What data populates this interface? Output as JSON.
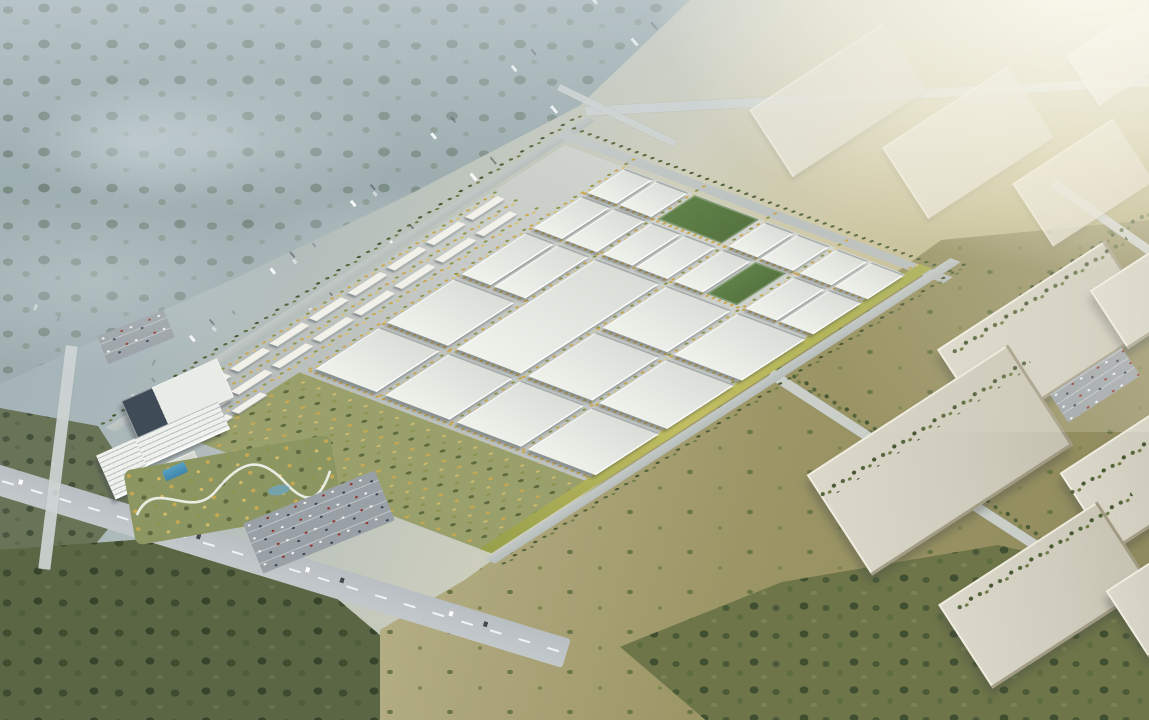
{
  "scene": {
    "type": "aerial-architectural-rendering",
    "subject": "industrial-logistics-park-masterplan",
    "palette": {
      "roof": "#F0F2EC",
      "roofShade": "#D9DCD6",
      "street": "#C6CBC7",
      "ctxRoof": "#CFCCBD",
      "lawn1": "#98A04B",
      "lawn2": "#C1BD62",
      "treeY1": "#CAA64D",
      "treeY2": "#DCC068",
      "treeO": "#8E9449",
      "treeD1": "#55643A",
      "treeD2": "#6F7C46",
      "forestCool": "#5D7063",
      "grassWarm": "#9B9464",
      "sunGlow": "#FFFDF2",
      "mistTint": "rgba(206,215,219,0.5)"
    },
    "park_items": [
      {
        "k": "proad",
        "x": -24,
        "y": -16,
        "w": 565,
        "h": 11,
        "n": "nw-boundary-road"
      },
      {
        "k": "tband",
        "x": -24,
        "y": -27,
        "w": 565,
        "h": 9
      },
      {
        "k": "proad",
        "x": 506,
        "y": -16,
        "w": 11,
        "h": 445,
        "n": "ne-boundary-road"
      },
      {
        "k": "tband",
        "x": 519,
        "y": -16,
        "w": 9,
        "h": 445
      },
      {
        "k": "garden",
        "x": 0,
        "y": 62,
        "w": 124,
        "h": 332,
        "n": "landscaped-garden-zone"
      },
      {
        "k": "lawn",
        "x": 0,
        "y": 390,
        "w": 518,
        "h": 14,
        "n": "se-lawn-strip"
      },
      {
        "k": "proad",
        "x": -10,
        "y": 406,
        "w": 548,
        "h": 12,
        "n": "se-boundary-road"
      },
      {
        "k": "tband",
        "x": -10,
        "y": 420,
        "w": 548,
        "h": 9
      },
      {
        "k": "tline",
        "x": 130,
        "y": 63,
        "w": 386,
        "h": 6
      },
      {
        "k": "tline",
        "x": 130,
        "y": 144,
        "w": 386,
        "h": 5
      },
      {
        "k": "tline",
        "x": 130,
        "y": 226,
        "w": 386,
        "h": 5
      },
      {
        "k": "tline",
        "x": 130,
        "y": 308,
        "w": 386,
        "h": 5
      },
      {
        "k": "tline",
        "x": 126,
        "y": 385,
        "w": 390,
        "h": 6
      },
      {
        "k": "tline",
        "x": 127,
        "y": 66,
        "w": 5,
        "h": 320
      },
      {
        "k": "tline",
        "x": 213,
        "y": 66,
        "w": 5,
        "h": 320
      },
      {
        "k": "tline",
        "x": 301,
        "y": 66,
        "w": 5,
        "h": 320
      },
      {
        "k": "tline",
        "x": 386,
        "y": 66,
        "w": 5,
        "h": 320
      },
      {
        "k": "tline",
        "x": 450,
        "y": 66,
        "w": 5,
        "h": 320
      },
      {
        "k": "tline",
        "x": 0,
        "y": 0,
        "w": 420,
        "h": 8
      },
      {
        "k": "tline",
        "x": 0,
        "y": 24,
        "w": 420,
        "h": 8
      },
      {
        "k": "tline",
        "x": 0,
        "y": 48,
        "w": 420,
        "h": 8
      },
      {
        "k": "field",
        "x": 455,
        "y": 150,
        "w": 44,
        "h": 74,
        "n": "sports-field"
      },
      {
        "k": "field",
        "x": 391,
        "y": 269,
        "w": 58,
        "h": 35,
        "n": "sports-field"
      },
      {
        "k": "wh",
        "x": 135,
        "y": 70,
        "w": 76,
        "h": 70
      },
      {
        "k": "wh",
        "x": 135,
        "y": 150,
        "w": 76,
        "h": 74
      },
      {
        "k": "wh",
        "x": 135,
        "y": 232,
        "w": 76,
        "h": 74
      },
      {
        "k": "wh",
        "x": 135,
        "y": 314,
        "w": 76,
        "h": 78
      },
      {
        "k": "wh",
        "x": 219,
        "y": 70,
        "w": 80,
        "h": 70
      },
      {
        "k": "wh",
        "x": 219,
        "y": 150,
        "w": 164,
        "h": 74,
        "n": "large-warehouse"
      },
      {
        "k": "wh",
        "x": 219,
        "y": 232,
        "w": 80,
        "h": 74
      },
      {
        "k": "wh",
        "x": 219,
        "y": 314,
        "w": 80,
        "h": 78
      },
      {
        "k": "wh",
        "x": 307,
        "y": 70,
        "w": 76,
        "h": 33
      },
      {
        "k": "wh",
        "x": 307,
        "y": 107,
        "w": 76,
        "h": 36
      },
      {
        "k": "wh",
        "x": 307,
        "y": 232,
        "w": 76,
        "h": 74
      },
      {
        "k": "wh",
        "x": 307,
        "y": 314,
        "w": 76,
        "h": 78
      },
      {
        "k": "wh",
        "x": 391,
        "y": 70,
        "w": 58,
        "h": 33
      },
      {
        "k": "wh",
        "x": 391,
        "y": 107,
        "w": 58,
        "h": 36
      },
      {
        "k": "wh",
        "x": 391,
        "y": 150,
        "w": 58,
        "h": 34
      },
      {
        "k": "wh",
        "x": 391,
        "y": 188,
        "w": 58,
        "h": 36
      },
      {
        "k": "wh",
        "x": 391,
        "y": 232,
        "w": 58,
        "h": 33
      },
      {
        "k": "wh",
        "x": 391,
        "y": 314,
        "w": 58,
        "h": 36
      },
      {
        "k": "wh",
        "x": 391,
        "y": 354,
        "w": 58,
        "h": 38
      },
      {
        "k": "wh",
        "x": 455,
        "y": 70,
        "w": 44,
        "h": 33
      },
      {
        "k": "wh",
        "x": 455,
        "y": 107,
        "w": 44,
        "h": 36
      },
      {
        "k": "wh",
        "x": 455,
        "y": 232,
        "w": 44,
        "h": 33
      },
      {
        "k": "wh",
        "x": 455,
        "y": 269,
        "w": 44,
        "h": 37
      },
      {
        "k": "wh",
        "x": 455,
        "y": 314,
        "w": 44,
        "h": 36
      },
      {
        "k": "wh",
        "x": 455,
        "y": 354,
        "w": 44,
        "h": 38
      },
      {
        "k": "res",
        "x": 6,
        "y": 8,
        "w": 38,
        "h": 10
      },
      {
        "k": "res",
        "x": 52,
        "y": 8,
        "w": 38,
        "h": 10
      },
      {
        "k": "res",
        "x": 98,
        "y": 8,
        "w": 38,
        "h": 10
      },
      {
        "k": "res",
        "x": 144,
        "y": 8,
        "w": 38,
        "h": 10
      },
      {
        "k": "res",
        "x": 190,
        "y": 8,
        "w": 38,
        "h": 10
      },
      {
        "k": "res",
        "x": 236,
        "y": 8,
        "w": 38,
        "h": 10
      },
      {
        "k": "res",
        "x": 282,
        "y": 8,
        "w": 38,
        "h": 10
      },
      {
        "k": "res",
        "x": 328,
        "y": 8,
        "w": 38,
        "h": 10
      },
      {
        "k": "res",
        "x": 374,
        "y": 8,
        "w": 38,
        "h": 10
      },
      {
        "k": "res",
        "x": 24,
        "y": 34,
        "w": 40,
        "h": 10
      },
      {
        "k": "res",
        "x": 72,
        "y": 34,
        "w": 40,
        "h": 10
      },
      {
        "k": "res",
        "x": 120,
        "y": 34,
        "w": 40,
        "h": 10
      },
      {
        "k": "res",
        "x": 168,
        "y": 34,
        "w": 40,
        "h": 10
      },
      {
        "k": "res",
        "x": 216,
        "y": 34,
        "w": 40,
        "h": 10
      },
      {
        "k": "res",
        "x": 264,
        "y": 34,
        "w": 40,
        "h": 10
      },
      {
        "k": "res",
        "x": 312,
        "y": 34,
        "w": 40,
        "h": 10
      },
      {
        "k": "res",
        "x": 360,
        "y": 34,
        "w": 40,
        "h": 10
      },
      {
        "k": "res",
        "x": 10,
        "y": 56,
        "w": 34,
        "h": 9
      },
      {
        "k": "res",
        "x": 50,
        "y": 56,
        "w": 34,
        "h": 9
      }
    ],
    "screen_items": [
      {
        "k": "rail",
        "x": 95,
        "y": 165,
        "w": 600,
        "h": 7,
        "r": -40,
        "n": "forest-highway"
      },
      {
        "k": "rail",
        "x": 135,
        "y": 205,
        "w": 600,
        "h": 9,
        "r": -40,
        "n": "forest-highway"
      },
      {
        "k": "rail",
        "x": -30,
        "y": 330,
        "w": 480,
        "h": 5,
        "r": -40,
        "o": 0.55,
        "n": "forest-road"
      },
      {
        "k": "rail",
        "x": -20,
        "y": 395,
        "w": 500,
        "h": 6,
        "r": 25,
        "o": 0.5,
        "n": "forest-road"
      },
      {
        "k": "arterial",
        "x": -40,
        "y": 548,
        "w": 620,
        "h": 30,
        "r": 17,
        "n": "main-arterial-road"
      },
      {
        "k": "sroad",
        "x": 52,
        "y": 345,
        "w": 12,
        "h": 225,
        "r": 7,
        "n": "west-access-road"
      },
      {
        "k": "sroad",
        "x": 585,
        "y": 92,
        "w": 564,
        "h": 9,
        "r": -3,
        "n": "north-road"
      },
      {
        "k": "sroad",
        "x": 552,
        "y": 112,
        "w": 130,
        "h": 7,
        "r": 26,
        "n": "north-connector-road"
      },
      {
        "k": "sroad",
        "x": 1040,
        "y": 222,
        "w": 150,
        "h": 9,
        "r": 35,
        "n": "east-road"
      },
      {
        "k": "tbs",
        "x": 735,
        "y": 477,
        "w": 440,
        "h": 9,
        "r": 33
      },
      {
        "k": "sroad",
        "x": 735,
        "y": 488,
        "w": 440,
        "h": 10,
        "r": 33,
        "n": "grassland-road"
      },
      {
        "k": "ctxh",
        "x": 758,
        "y": 60,
        "w": 160,
        "h": 80,
        "r": -33
      },
      {
        "k": "ctxh",
        "x": 893,
        "y": 100,
        "w": 150,
        "h": 85,
        "r": -33
      },
      {
        "k": "ctxh",
        "x": 1023,
        "y": 145,
        "w": 120,
        "h": 75,
        "r": -33
      },
      {
        "k": "ctxh",
        "x": 1075,
        "y": 25,
        "w": 95,
        "h": 60,
        "r": -33
      },
      {
        "k": "tbs",
        "x": 1005,
        "y": 250,
        "w": 160,
        "h": 9,
        "r": -33
      },
      {
        "k": "ctx",
        "x": 948,
        "y": 287,
        "w": 200,
        "h": 100,
        "r": -33
      },
      {
        "k": "ctx",
        "x": 1100,
        "y": 255,
        "w": 110,
        "h": 70,
        "r": -33
      },
      {
        "k": "tbs",
        "x": 935,
        "y": 292,
        "w": 210,
        "h": 10,
        "r": -33
      },
      {
        "k": "ctx",
        "x": 820,
        "y": 400,
        "w": 240,
        "h": 120,
        "r": -33
      },
      {
        "k": "tbs",
        "x": 800,
        "y": 424,
        "w": 250,
        "h": 11,
        "r": -33
      },
      {
        "k": "ctx",
        "x": 1075,
        "y": 430,
        "w": 130,
        "h": 95,
        "r": -33
      },
      {
        "k": "tbs",
        "x": 1058,
        "y": 452,
        "w": 140,
        "h": 9,
        "r": -33
      },
      {
        "k": "ctx",
        "x": 950,
        "y": 545,
        "w": 190,
        "h": 100,
        "r": -33
      },
      {
        "k": "ctx",
        "x": 1120,
        "y": 560,
        "w": 90,
        "h": 80,
        "r": -33
      },
      {
        "k": "tbs",
        "x": 940,
        "y": 548,
        "w": 210,
        "h": 10,
        "r": -33
      },
      {
        "k": "parking",
        "x": 248,
        "y": 495,
        "w": 142,
        "h": 54,
        "r": -22,
        "n": "visitor-parking-lot"
      },
      {
        "k": "parking",
        "x": 100,
        "y": 322,
        "w": 72,
        "h": 30,
        "r": -22,
        "n": "residential-parking-lot"
      },
      {
        "k": "parking",
        "x": 1052,
        "y": 368,
        "w": 86,
        "h": 34,
        "r": -33,
        "n": "context-parking-lot"
      }
    ],
    "kind_names": {
      "wh": "warehouse-building",
      "res": "apartment-building",
      "proad": "park-road",
      "tband": "tree-band",
      "tline": "street-tree-line",
      "lawn": "lawn-strip",
      "field": "sports-field",
      "garden": "landscaped-garden",
      "ctx": "context-warehouse",
      "ctxh": "context-warehouse-hazy",
      "sroad": "road",
      "rail": "forest-road",
      "arterial": "arterial-road",
      "parking": "parking-lot",
      "tbs": "tree-band"
    }
  }
}
